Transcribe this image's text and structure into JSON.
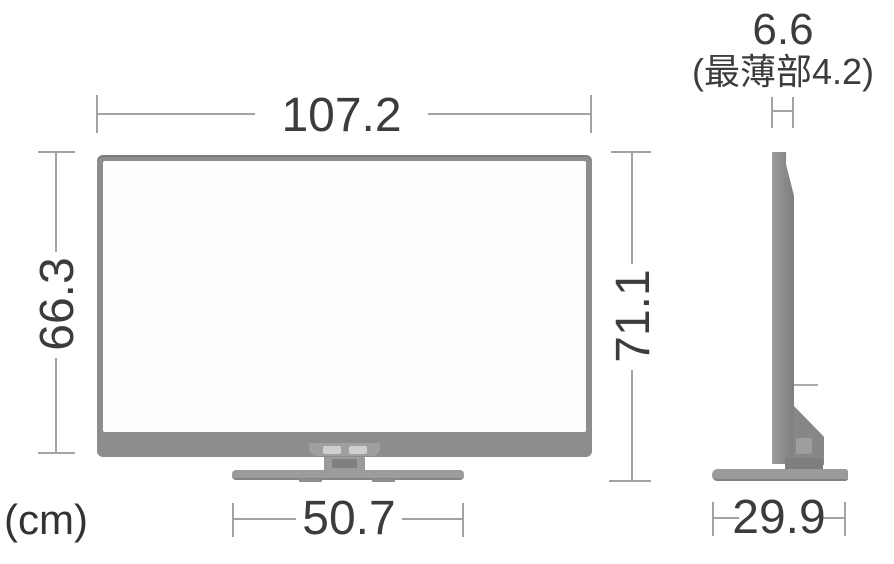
{
  "diagram": {
    "type": "tv-dimension-diagram",
    "unit": "(cm)",
    "front_view": {
      "width": "107.2",
      "panel_height": "66.3",
      "overall_height": "71.1",
      "stand_width": "50.7"
    },
    "side_view": {
      "thickness": "6.6",
      "thinnest_part_note": "(最薄部4.2)",
      "stand_depth": "29.9"
    },
    "colors": {
      "tv_body_gray": "#8d8d8d",
      "dimension_line_gray": "#a3a3a3",
      "text_color": "#3c3c3c",
      "background": "#ffffff"
    }
  }
}
